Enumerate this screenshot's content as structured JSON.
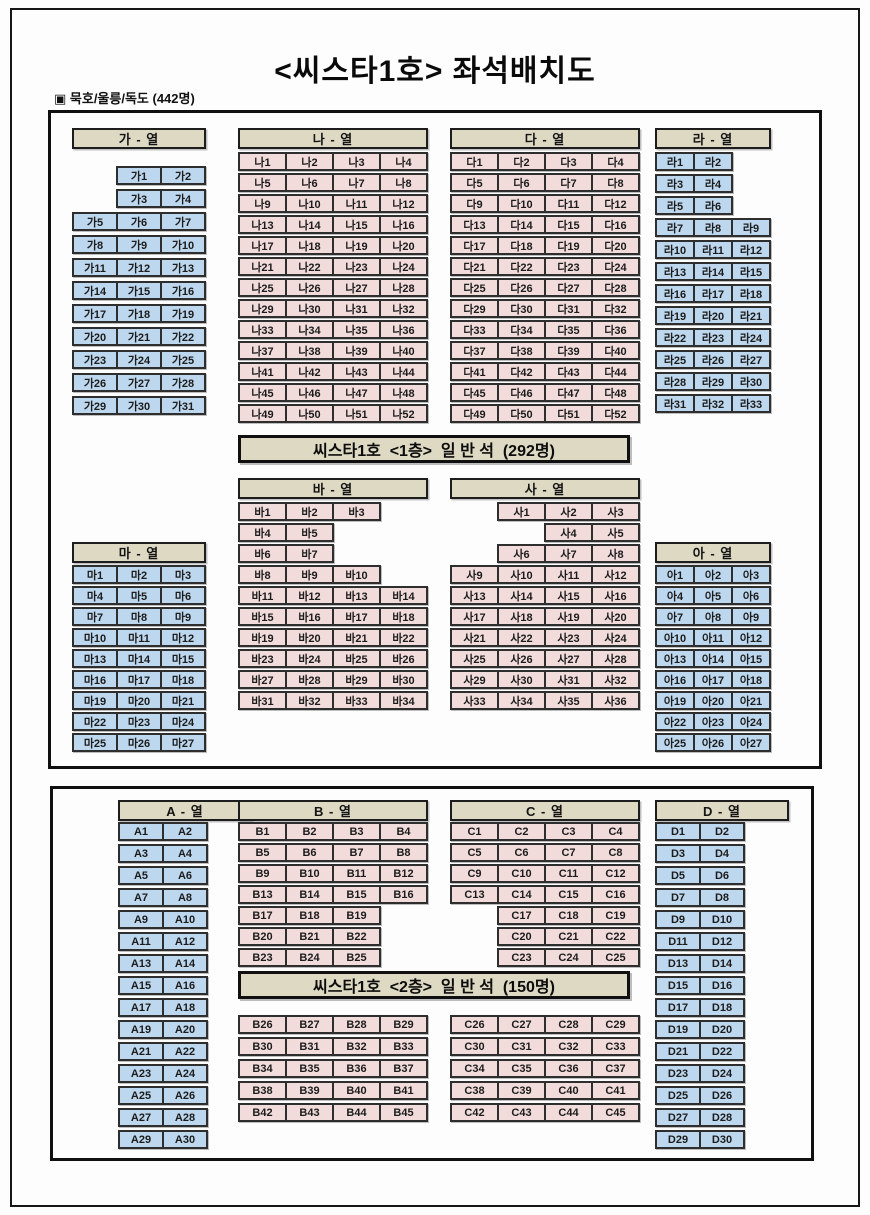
{
  "title": "<씨스타1호> 좌석배치도",
  "subtitle": "▣ 묵호/울릉/독도 (442명)",
  "banners": {
    "deck1": "씨스타1호  <1층>  일 반 석  (292명)",
    "deck2": "씨스타1호  <2층>  일 반 석  (150명)"
  },
  "colors": {
    "seat_blue": "#bdd7ee",
    "seat_pink": "#f2dcdb",
    "header_beige": "#ddd9c3",
    "border_dark": "#2e2e2e"
  },
  "sections": {
    "ga": {
      "header": "가 - 열",
      "color": "blue",
      "rows": [
        [
          null,
          "가1",
          "가2"
        ],
        [
          null,
          "가3",
          "가4"
        ],
        [
          "가5",
          "가6",
          "가7"
        ],
        [
          "가8",
          "가9",
          "가10"
        ],
        [
          "가11",
          "가12",
          "가13"
        ],
        [
          "가14",
          "가15",
          "가16"
        ],
        [
          "가17",
          "가18",
          "가19"
        ],
        [
          "가20",
          "가21",
          "가22"
        ],
        [
          "가23",
          "가24",
          "가25"
        ],
        [
          "가26",
          "가27",
          "가28"
        ],
        [
          "가29",
          "가30",
          "가31"
        ]
      ]
    },
    "na": {
      "header": "나 - 열",
      "color": "pink",
      "rows": [
        [
          "나1",
          "나2",
          "나3",
          "나4"
        ],
        [
          "나5",
          "나6",
          "나7",
          "나8"
        ],
        [
          "나9",
          "나10",
          "나11",
          "나12"
        ],
        [
          "나13",
          "나14",
          "나15",
          "나16"
        ],
        [
          "나17",
          "나18",
          "나19",
          "나20"
        ],
        [
          "나21",
          "나22",
          "나23",
          "나24"
        ],
        [
          "나25",
          "나26",
          "나27",
          "나28"
        ],
        [
          "나29",
          "나30",
          "나31",
          "나32"
        ],
        [
          "나33",
          "나34",
          "나35",
          "나36"
        ],
        [
          "나37",
          "나38",
          "나39",
          "나40"
        ],
        [
          "나41",
          "나42",
          "나43",
          "나44"
        ],
        [
          "나45",
          "나46",
          "나47",
          "나48"
        ],
        [
          "나49",
          "나50",
          "나51",
          "나52"
        ]
      ]
    },
    "da": {
      "header": "다 - 열",
      "color": "pink",
      "rows": [
        [
          "다1",
          "다2",
          "다3",
          "다4"
        ],
        [
          "다5",
          "다6",
          "다7",
          "다8"
        ],
        [
          "다9",
          "다10",
          "다11",
          "다12"
        ],
        [
          "다13",
          "다14",
          "다15",
          "다16"
        ],
        [
          "다17",
          "다18",
          "다19",
          "다20"
        ],
        [
          "다21",
          "다22",
          "다23",
          "다24"
        ],
        [
          "다25",
          "다26",
          "다27",
          "다28"
        ],
        [
          "다29",
          "다30",
          "다31",
          "다32"
        ],
        [
          "다33",
          "다34",
          "다35",
          "다36"
        ],
        [
          "다37",
          "다38",
          "다39",
          "다40"
        ],
        [
          "다41",
          "다42",
          "다43",
          "다44"
        ],
        [
          "다45",
          "다46",
          "다47",
          "다48"
        ],
        [
          "다49",
          "다50",
          "다51",
          "다52"
        ]
      ]
    },
    "ra": {
      "header": "라 - 열",
      "color": "blue",
      "rows": [
        [
          "라1",
          "라2",
          null
        ],
        [
          "라3",
          "라4",
          null
        ],
        [
          "라5",
          "라6",
          null
        ],
        [
          "라7",
          "라8",
          "라9"
        ],
        [
          "라10",
          "라11",
          "라12"
        ],
        [
          "라13",
          "라14",
          "라15"
        ],
        [
          "라16",
          "라17",
          "라18"
        ],
        [
          "라19",
          "라20",
          "라21"
        ],
        [
          "라22",
          "라23",
          "라24"
        ],
        [
          "라25",
          "라26",
          "라27"
        ],
        [
          "라28",
          "라29",
          "라30"
        ],
        [
          "라31",
          "라32",
          "라33"
        ]
      ]
    },
    "ba": {
      "header": "바 - 열",
      "color": "pink",
      "rows": [
        [
          "바1",
          "바2",
          "바3",
          null
        ],
        [
          "바4",
          "바5",
          null,
          null
        ],
        [
          "바6",
          "바7",
          null,
          null
        ],
        [
          "바8",
          "바9",
          "바10",
          null
        ],
        [
          "바11",
          "바12",
          "바13",
          "바14"
        ],
        [
          "바15",
          "바16",
          "바17",
          "바18"
        ],
        [
          "바19",
          "바20",
          "바21",
          "바22"
        ],
        [
          "바23",
          "바24",
          "바25",
          "바26"
        ],
        [
          "바27",
          "바28",
          "바29",
          "바30"
        ],
        [
          "바31",
          "바32",
          "바33",
          "바34"
        ]
      ]
    },
    "sa": {
      "header": "사 - 열",
      "color": "pink",
      "rows": [
        [
          null,
          "사1",
          "사2",
          "사3"
        ],
        [
          null,
          null,
          "사4",
          "사5"
        ],
        [
          null,
          "사6",
          "사7",
          "사8"
        ],
        [
          "사9",
          "사10",
          "사11",
          "사12"
        ],
        [
          "사13",
          "사14",
          "사15",
          "사16"
        ],
        [
          "사17",
          "사18",
          "사19",
          "사20"
        ],
        [
          "사21",
          "사22",
          "사23",
          "사24"
        ],
        [
          "사25",
          "사26",
          "사27",
          "사28"
        ],
        [
          "사29",
          "사30",
          "사31",
          "사32"
        ],
        [
          "사33",
          "사34",
          "사35",
          "사36"
        ]
      ]
    },
    "ma": {
      "header": "마 - 열",
      "color": "blue",
      "rows": [
        [
          "마1",
          "마2",
          "마3"
        ],
        [
          "마4",
          "마5",
          "마6"
        ],
        [
          "마7",
          "마8",
          "마9"
        ],
        [
          "마10",
          "마11",
          "마12"
        ],
        [
          "마13",
          "마14",
          "마15"
        ],
        [
          "마16",
          "마17",
          "마18"
        ],
        [
          "마19",
          "마20",
          "마21"
        ],
        [
          "마22",
          "마23",
          "마24"
        ],
        [
          "마25",
          "마26",
          "마27"
        ]
      ]
    },
    "ah": {
      "header": "아 - 열",
      "color": "blue",
      "rows": [
        [
          "아1",
          "아2",
          "아3"
        ],
        [
          "아4",
          "아5",
          "아6"
        ],
        [
          "아7",
          "아8",
          "아9"
        ],
        [
          "아10",
          "아11",
          "아12"
        ],
        [
          "아13",
          "아14",
          "아15"
        ],
        [
          "아16",
          "아17",
          "아18"
        ],
        [
          "아19",
          "아20",
          "아21"
        ],
        [
          "아22",
          "아23",
          "아24"
        ],
        [
          "아25",
          "아26",
          "아27"
        ]
      ]
    },
    "A": {
      "header": "A - 열",
      "color": "blue",
      "rows": [
        [
          "A1",
          "A2"
        ],
        [
          "A3",
          "A4"
        ],
        [
          "A5",
          "A6"
        ],
        [
          "A7",
          "A8"
        ],
        [
          "A9",
          "A10"
        ],
        [
          "A11",
          "A12"
        ],
        [
          "A13",
          "A14"
        ],
        [
          "A15",
          "A16"
        ],
        [
          "A17",
          "A18"
        ],
        [
          "A19",
          "A20"
        ],
        [
          "A21",
          "A22"
        ],
        [
          "A23",
          "A24"
        ],
        [
          "A25",
          "A26"
        ],
        [
          "A27",
          "A28"
        ],
        [
          "A29",
          "A30"
        ]
      ]
    },
    "B": {
      "header": "B - 열",
      "color": "pink",
      "rows_top": [
        [
          "B1",
          "B2",
          "B3",
          "B4"
        ],
        [
          "B5",
          "B6",
          "B7",
          "B8"
        ],
        [
          "B9",
          "B10",
          "B11",
          "B12"
        ],
        [
          "B13",
          "B14",
          "B15",
          "B16"
        ],
        [
          "B17",
          "B18",
          "B19",
          null
        ],
        [
          "B20",
          "B21",
          "B22",
          null
        ],
        [
          "B23",
          "B24",
          "B25",
          null
        ]
      ],
      "rows_bottom": [
        [
          "B26",
          "B27",
          "B28",
          "B29"
        ],
        [
          "B30",
          "B31",
          "B32",
          "B33"
        ],
        [
          "B34",
          "B35",
          "B36",
          "B37"
        ],
        [
          "B38",
          "B39",
          "B40",
          "B41"
        ],
        [
          "B42",
          "B43",
          "B44",
          "B45"
        ]
      ]
    },
    "C": {
      "header": "C - 열",
      "color": "pink",
      "rows_top": [
        [
          "C1",
          "C2",
          "C3",
          "C4"
        ],
        [
          "C5",
          "C6",
          "C7",
          "C8"
        ],
        [
          "C9",
          "C10",
          "C11",
          "C12"
        ],
        [
          "C13",
          "C14",
          "C15",
          "C16"
        ],
        [
          null,
          "C17",
          "C18",
          "C19"
        ],
        [
          null,
          "C20",
          "C21",
          "C22"
        ],
        [
          null,
          "C23",
          "C24",
          "C25"
        ]
      ],
      "rows_bottom": [
        [
          "C26",
          "C27",
          "C28",
          "C29"
        ],
        [
          "C30",
          "C31",
          "C32",
          "C33"
        ],
        [
          "C34",
          "C35",
          "C36",
          "C37"
        ],
        [
          "C38",
          "C39",
          "C40",
          "C41"
        ],
        [
          "C42",
          "C43",
          "C44",
          "C45"
        ]
      ]
    },
    "D": {
      "header": "D - 열",
      "color": "blue",
      "rows": [
        [
          "D1",
          "D2"
        ],
        [
          "D3",
          "D4"
        ],
        [
          "D5",
          "D6"
        ],
        [
          "D7",
          "D8"
        ],
        [
          "D9",
          "D10"
        ],
        [
          "D11",
          "D12"
        ],
        [
          "D13",
          "D14"
        ],
        [
          "D15",
          "D16"
        ],
        [
          "D17",
          "D18"
        ],
        [
          "D19",
          "D20"
        ],
        [
          "D21",
          "D22"
        ],
        [
          "D23",
          "D24"
        ],
        [
          "D25",
          "D26"
        ],
        [
          "D27",
          "D28"
        ],
        [
          "D29",
          "D30"
        ]
      ]
    }
  }
}
